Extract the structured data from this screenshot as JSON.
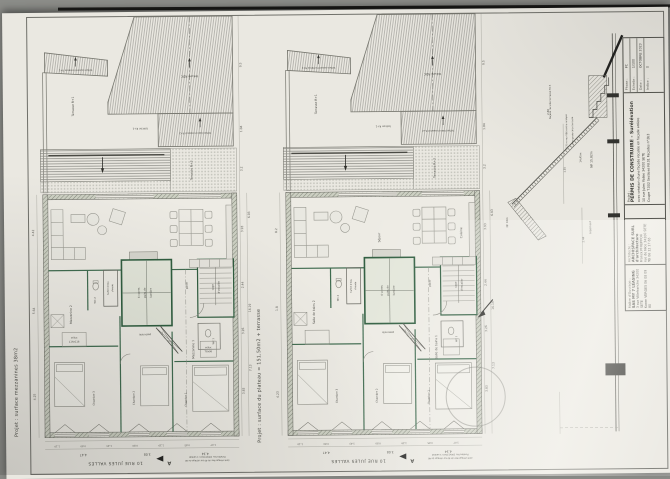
{
  "photo": {
    "bg": "#8b8c88",
    "paper": "#eae8e1",
    "ink": "#4b4b45",
    "green": "#3f6b4f"
  },
  "planA": {
    "caption_side": "Projet : surface mezzanines 38m2",
    "roof": {
      "auvent": "toiture auvent terrasse R+1",
      "rdc": "toiture RDC",
      "terrasse_r1": "Terrasse R+1",
      "balcon_r1": "balcon R+1",
      "avancee": "toiture balcon avancé R+2",
      "terrasse_r3": "Terrasse R+3"
    },
    "rooms": {
      "sejour": "",
      "cuisine": "",
      "shaft1": "4 verres",
      "shaft2": "puits de",
      "shaft3": "lumière",
      "ballon1": "ballon d'eau",
      "ballon2": "chaude",
      "wc2": "WC 2",
      "palier": "palier",
      "passerelle": "passerelle",
      "cage1": "cage",
      "cage2": "d'escalier",
      "wc1": "WC 1",
      "midleft": "Mezzanine 2",
      "midleft_sub1": "vélux",
      "midleft_sub2": "114x118",
      "midright": "Mezzanine 1",
      "midright_sub1": "vélux",
      "midright_sub2": "78x98",
      "ch1": "Chambre 1",
      "ch2": "Chambre 2",
      "ch3": "Chambre 3"
    },
    "dims_left": [
      "4.42",
      "5.64",
      "4.25"
    ],
    "dims_right": [
      "9.5",
      "1.04",
      "3.2",
      "6.93",
      "3.93",
      "2.44",
      "16.19",
      "3.26",
      "7.13",
      "3.83"
    ],
    "dims_bottom": [
      "1.10",
      "0.80",
      "1.43",
      "0.80",
      "1.29",
      "0.85",
      "1.07"
    ],
    "dims_total": [
      "4.47",
      "3.08",
      "4.34"
    ],
    "street": "10 RUE JULES VALLES",
    "marker": "A",
    "win_note1": "Fenêtre feu 100x150cm 1 vantail",
    "win_note2": "dont vitrage fixe de 40 sur vitrage de 40"
  },
  "planB": {
    "caption_side": "Projet : surface du plateau = 151,50m2 + terrasse",
    "roof": {
      "auvent": "toiture auvent terrasse R+1",
      "rdc": "toiture RDC",
      "terrasse_r1": "Terrasse R+1",
      "balcon_r1": "balcon R+1",
      "avancee": "toiture balcon avancé R+2",
      "terrasse_r3": "Terrasse R+3"
    },
    "rooms": {
      "sejour": "Séjour",
      "cuisine": "Cuisine",
      "shaft1": "4 verres",
      "shaft2": "puits de",
      "shaft3": "lumière",
      "ballon1": "ballon d'eau",
      "ballon2": "chaude",
      "wc2": "WC 2",
      "palier": "palier",
      "passerelle": "passerelle",
      "cage1": "cage",
      "cage2": "d'escalier",
      "wc1": "WC 1",
      "midleft": "Salle de bains 2",
      "midleft_sub1": "",
      "midleft_sub2": "",
      "midright": "Salle de bains 1",
      "midright_sub1": "",
      "midright_sub2": "",
      "ch1": "Chambre 1",
      "ch2": "Chambre 2",
      "ch3": "Chambre 3"
    },
    "dims_left": [
      "8.2",
      "1.8",
      "4.23"
    ],
    "dims_right": [
      "9.5",
      "1.04",
      "3.2",
      "6.93",
      "3.93",
      "2.44",
      "16.19",
      "3.26",
      "7.13",
      "3.83"
    ],
    "dims_bottom": [
      "1.10",
      "0.80",
      "1.43",
      "0.80",
      "1.29",
      "0.85",
      "1.07"
    ],
    "dims_total": [
      "4.47",
      "3.08",
      "4.34"
    ],
    "street": "10 RUE JULES VALLES",
    "marker": "A",
    "win_note1": "Fenêtre feu 100x150cm 1 vantail",
    "win_note2": "dont vitrage fixe de 40 sur vitrage de 40"
  },
  "section": {
    "facade": "Façade reculée terrasse R+3",
    "mur": "(3,7) m mur R06 contre mitoyen",
    "garde": "L. lien garde corps terrasse",
    "d1445": "14,45m",
    "nf1582": "NF 15,82m",
    "d288": "2.88",
    "d101": "1.01",
    "nf18": "NF 18m",
    "logement": "Logement",
    "d244": "2.44"
  },
  "titleblock": {
    "phase_label": "Phase :",
    "phase": "PC",
    "echelle_label": "Echelle :",
    "echelle": "1/100",
    "date_label": "Date :",
    "date": "OCTOBRE 2023",
    "indice_label": "Indice :",
    "indice": "0",
    "projet_label": "Projet :",
    "title": "PERMIS DE CONSTRUIRE - Surélévation",
    "subtitle": "avec création d'une façade reculée en façade arrière",
    "address": "10 rue Jules Valles 34200 SETE",
    "sheets": "Coupe T.002  Sections NI.01  Façades n°2b3",
    "moe_label": "Architecte :",
    "moe_name": "ARCHISPACE SURL d'architecture",
    "moe_contact": "Franck PHILIPPOU",
    "moe_addr": "rue de Nice 34200 SETE",
    "moe_tel": "Tél 06 12 17 65",
    "moa_label": "Maître d'Ouvrage :",
    "moa_name": "SAS MY 7 LEASING",
    "moa_addr": "3 rue Villefranche 34200 SETE",
    "moa_contact": "Karen VERGES 06 08 09 80"
  }
}
